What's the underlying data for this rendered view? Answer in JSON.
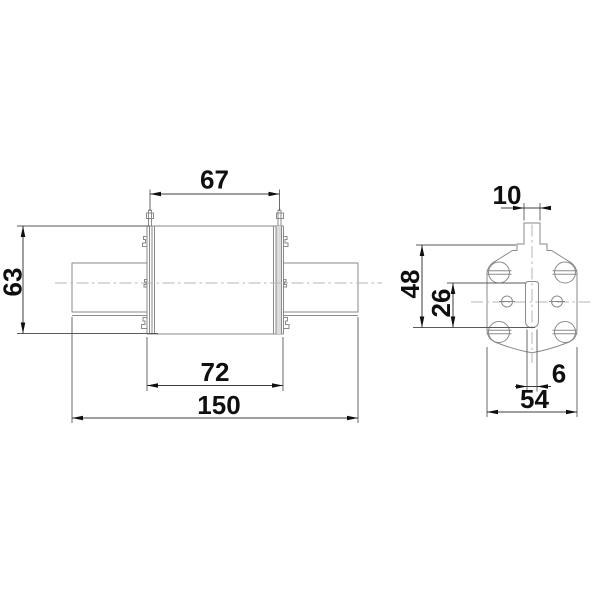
{
  "drawing": {
    "type": "fuse-link-technical-drawing",
    "front_view": {
      "dims": {
        "top_width": "67",
        "height": "63",
        "body_width": "72",
        "total_length": "150"
      }
    },
    "side_view": {
      "dims": {
        "blade_width": "10",
        "overall_height": "48",
        "slot_height": "26",
        "slot_width": "6",
        "body_width": "54"
      }
    },
    "colors": {
      "geometry_line": "#8a8a8a",
      "centerline": "#b5b5b5",
      "dimension_line": "#3d3d3d",
      "dimension_text": "#0f0f0f",
      "end_cap_fill": "#dcdcdc",
      "background": "#ffffff"
    }
  }
}
